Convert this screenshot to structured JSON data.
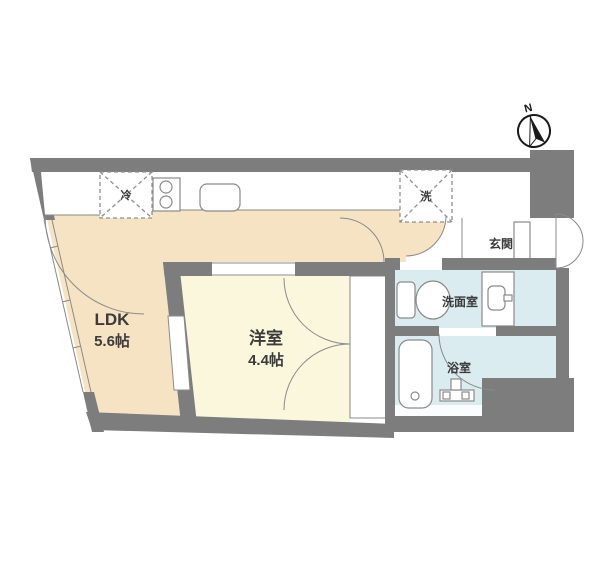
{
  "compass": {
    "north_label": "N"
  },
  "rooms": {
    "ldk": {
      "name": "LDK",
      "size": "5.6帖"
    },
    "western_room": {
      "name": "洋室",
      "size": "4.4帖"
    },
    "entrance": {
      "name": "玄関"
    },
    "washroom": {
      "name": "洗面室"
    },
    "bathroom": {
      "name": "浴室"
    }
  },
  "appliances": {
    "refrigerator": "冷",
    "washing_machine": "洗"
  },
  "colors": {
    "wall": "#7d7d7d",
    "ldk_floor": "#f6e3c3",
    "western_room_floor": "#fbf7dd",
    "wet_area_floor": "#daecf0",
    "outline": "#8a8a8a",
    "text": "#3b3b3b"
  }
}
